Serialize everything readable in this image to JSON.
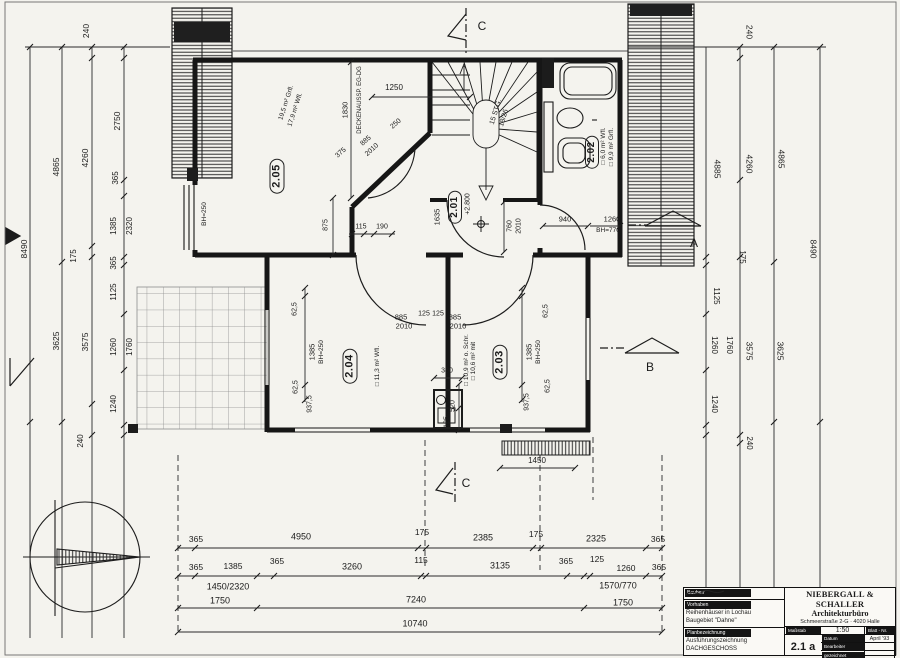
{
  "drawing_title": "DACHGESCHOSS",
  "title_block": {
    "owner_label": "Bauherr",
    "project_label": "Vorhaben",
    "project_line1": "Reihenhäuser in Lochau",
    "project_line2": "Baugebiet \"Dahne\"",
    "plan_label": "Planbezeichnung",
    "plan_line1": "Ausführungszeichnung",
    "plan_line2": "DACHGESCHOSS",
    "firm_name": "NIEBERGALL & SCHALLER",
    "firm_type": "Architekturbüro",
    "firm_address": "Schmeerstraße 2-G · 4020 Halle",
    "scale_label": "Maßstab",
    "scale_value": "1:50",
    "sheet_label": "Blatt - Nr.",
    "sheet_value": "2.1 a",
    "date_label": "Datum",
    "date_value": "April '93",
    "editor_label": "Bearbeiter",
    "drawn_label": "gezeichnet"
  },
  "plan_labels": [
    {
      "t": "2.05",
      "x": 277,
      "y": 176,
      "r": -90,
      "s": 11,
      "c": "room"
    },
    {
      "t": "2.01",
      "x": 455,
      "y": 207,
      "r": -90,
      "s": 10,
      "c": "room"
    },
    {
      "t": "2.02",
      "x": 592,
      "y": 152,
      "r": -90,
      "s": 10,
      "c": "room"
    },
    {
      "t": "2.04",
      "x": 350,
      "y": 366,
      "r": -90,
      "s": 11,
      "c": "room"
    },
    {
      "t": "2.03",
      "x": 500,
      "y": 362,
      "r": -90,
      "s": 11,
      "c": "room"
    },
    {
      "t": "19,5 m² Grfl.",
      "x": 287,
      "y": 103,
      "r": -72,
      "s": 6.5,
      "c": "note"
    },
    {
      "t": "17,9 m² Wfl.",
      "x": 296,
      "y": 110,
      "r": -72,
      "s": 6.5,
      "c": "note"
    },
    {
      "t": "□ 6,0 m² Wfl.",
      "x": 604,
      "y": 146,
      "r": -90,
      "s": 6.5,
      "c": "note"
    },
    {
      "t": "□ 9,9 m² Grfl.",
      "x": 612,
      "y": 147,
      "r": -90,
      "s": 6.5,
      "c": "note"
    },
    {
      "t": "□ 11,3 m² Wfl.",
      "x": 378,
      "y": 366,
      "r": -90,
      "s": 6.5,
      "c": "note"
    },
    {
      "t": "□ 10,9 m² o. Schr.",
      "x": 467,
      "y": 360,
      "r": -90,
      "s": 6.5,
      "c": "note"
    },
    {
      "t": "□ 10,6 m² mit",
      "x": 474,
      "y": 361,
      "r": -90,
      "s": 6.5,
      "c": "note"
    },
    {
      "t": "15 STG.",
      "x": 496,
      "y": 112,
      "r": -73,
      "s": 7,
      "c": "note"
    },
    {
      "t": "18/26",
      "x": 504,
      "y": 118,
      "r": -73,
      "s": 7,
      "c": "note"
    },
    {
      "t": "DECKENAUSSP. EG-DG",
      "x": 360,
      "y": 100,
      "r": -90,
      "s": 6,
      "c": "note"
    },
    {
      "t": "1830",
      "x": 345,
      "y": 110,
      "r": -90,
      "s": 7.5
    },
    {
      "t": "1250",
      "x": 394,
      "y": 88,
      "s": 8
    },
    {
      "t": "375",
      "x": 341,
      "y": 153,
      "r": -42,
      "s": 7
    },
    {
      "t": "885",
      "x": 366,
      "y": 141,
      "r": -42,
      "s": 7
    },
    {
      "t": "2010",
      "x": 372,
      "y": 150,
      "r": -42,
      "s": 7
    },
    {
      "t": "250",
      "x": 396,
      "y": 124,
      "r": -42,
      "s": 7
    },
    {
      "t": "BH=250",
      "x": 205,
      "y": 214,
      "r": -90,
      "s": 6.5
    },
    {
      "t": "875",
      "x": 326,
      "y": 225,
      "r": -90,
      "s": 7
    },
    {
      "t": "115",
      "x": 361,
      "y": 227,
      "s": 7
    },
    {
      "t": "190",
      "x": 382,
      "y": 227,
      "s": 7
    },
    {
      "t": "1635",
      "x": 437,
      "y": 217,
      "r": -90,
      "s": 7.5
    },
    {
      "t": "+2.800",
      "x": 468,
      "y": 204,
      "r": -90,
      "s": 7
    },
    {
      "t": "760",
      "x": 510,
      "y": 226,
      "r": -90,
      "s": 7
    },
    {
      "t": "2010",
      "x": 519,
      "y": 226,
      "r": -90,
      "s": 7
    },
    {
      "t": "940",
      "x": 565,
      "y": 219,
      "s": 7.5
    },
    {
      "t": "1260",
      "x": 612,
      "y": 219,
      "s": 7.5
    },
    {
      "t": "BH=770",
      "x": 608,
      "y": 231,
      "s": 6.5
    },
    {
      "t": "62,5",
      "x": 295,
      "y": 309,
      "r": -90,
      "s": 7
    },
    {
      "t": "62,5",
      "x": 296,
      "y": 387,
      "r": -90,
      "s": 7
    },
    {
      "t": "1385",
      "x": 312,
      "y": 352,
      "r": -90,
      "s": 7.5
    },
    {
      "t": "BH=250",
      "x": 322,
      "y": 352,
      "r": -90,
      "s": 6.5
    },
    {
      "t": "937,5",
      "x": 310,
      "y": 404,
      "r": -90,
      "s": 7
    },
    {
      "t": "885",
      "x": 401,
      "y": 317,
      "s": 7.5
    },
    {
      "t": "2010",
      "x": 404,
      "y": 326,
      "s": 7.5
    },
    {
      "t": "125",
      "x": 424,
      "y": 314,
      "s": 7
    },
    {
      "t": "125",
      "x": 438,
      "y": 314,
      "s": 7
    },
    {
      "t": "885",
      "x": 455,
      "y": 317,
      "s": 7.5
    },
    {
      "t": "2010",
      "x": 458,
      "y": 326,
      "s": 7.5
    },
    {
      "t": "62,5",
      "x": 546,
      "y": 311,
      "r": -90,
      "s": 7
    },
    {
      "t": "62,5",
      "x": 548,
      "y": 386,
      "r": -90,
      "s": 7
    },
    {
      "t": "1385",
      "x": 529,
      "y": 352,
      "r": -90,
      "s": 7.5
    },
    {
      "t": "BH=250",
      "x": 539,
      "y": 352,
      "r": -90,
      "s": 6.5
    },
    {
      "t": "937,5",
      "x": 527,
      "y": 402,
      "r": -90,
      "s": 7
    },
    {
      "t": "380",
      "x": 447,
      "y": 371,
      "s": 7
    },
    {
      "t": "520",
      "x": 453,
      "y": 406,
      "r": -90,
      "s": 7
    },
    {
      "t": "125",
      "x": 447,
      "y": 422,
      "r": -90,
      "s": 7
    },
    {
      "t": "1450",
      "x": 537,
      "y": 461,
      "s": 8
    },
    {
      "t": "240",
      "x": 86,
      "y": 31,
      "r": -90,
      "s": 8.5
    },
    {
      "t": "2750",
      "x": 117,
      "y": 121,
      "r": -90,
      "s": 8.5
    },
    {
      "t": "4865",
      "x": 56,
      "y": 167,
      "r": -90,
      "s": 8.5
    },
    {
      "t": "4260",
      "x": 85,
      "y": 158,
      "r": -90,
      "s": 8.5
    },
    {
      "t": "365",
      "x": 116,
      "y": 178,
      "r": -90,
      "s": 8
    },
    {
      "t": "1385",
      "x": 114,
      "y": 226,
      "r": -90,
      "s": 8
    },
    {
      "t": "2320",
      "x": 130,
      "y": 226,
      "r": -90,
      "s": 8
    },
    {
      "t": "8490",
      "x": 24,
      "y": 249,
      "r": -90,
      "s": 8.5
    },
    {
      "t": "175",
      "x": 74,
      "y": 256,
      "r": -90,
      "s": 8
    },
    {
      "t": "365",
      "x": 114,
      "y": 263,
      "r": -90,
      "s": 8
    },
    {
      "t": "1125",
      "x": 114,
      "y": 292,
      "r": -90,
      "s": 8
    },
    {
      "t": "3625",
      "x": 56,
      "y": 341,
      "r": -90,
      "s": 8.5
    },
    {
      "t": "3575",
      "x": 85,
      "y": 342,
      "r": -90,
      "s": 8.5
    },
    {
      "t": "1260",
      "x": 114,
      "y": 347,
      "r": -90,
      "s": 8
    },
    {
      "t": "1760",
      "x": 130,
      "y": 347,
      "r": -90,
      "s": 8
    },
    {
      "t": "1240",
      "x": 114,
      "y": 404,
      "r": -90,
      "s": 8
    },
    {
      "t": "240",
      "x": 81,
      "y": 441,
      "r": -90,
      "s": 8
    },
    {
      "t": "240",
      "x": 749,
      "y": 32,
      "r": 90,
      "s": 8.5
    },
    {
      "t": "4885",
      "x": 717,
      "y": 169,
      "r": 90,
      "s": 8.5
    },
    {
      "t": "4260",
      "x": 749,
      "y": 164,
      "r": 90,
      "s": 8.5
    },
    {
      "t": "4865",
      "x": 781,
      "y": 159,
      "r": 90,
      "s": 8.5
    },
    {
      "t": "8490",
      "x": 813,
      "y": 249,
      "r": 90,
      "s": 8.5
    },
    {
      "t": "175",
      "x": 742,
      "y": 257,
      "r": 90,
      "s": 8
    },
    {
      "t": "1125",
      "x": 716,
      "y": 296,
      "r": 90,
      "s": 8
    },
    {
      "t": "1260",
      "x": 714,
      "y": 345,
      "r": 90,
      "s": 8
    },
    {
      "t": "1760",
      "x": 729,
      "y": 345,
      "r": 90,
      "s": 8
    },
    {
      "t": "3575",
      "x": 749,
      "y": 351,
      "r": 90,
      "s": 8.5
    },
    {
      "t": "3625",
      "x": 780,
      "y": 351,
      "r": 90,
      "s": 8.5
    },
    {
      "t": "1240",
      "x": 714,
      "y": 404,
      "r": 90,
      "s": 8
    },
    {
      "t": "240",
      "x": 749,
      "y": 443,
      "r": 90,
      "s": 8
    },
    {
      "t": "365",
      "x": 196,
      "y": 539,
      "s": 8.5
    },
    {
      "t": "4950",
      "x": 301,
      "y": 537,
      "s": 9
    },
    {
      "t": "175",
      "x": 422,
      "y": 532,
      "s": 8.5
    },
    {
      "t": "2385",
      "x": 483,
      "y": 538,
      "s": 9
    },
    {
      "t": "175",
      "x": 536,
      "y": 534,
      "s": 8.5
    },
    {
      "t": "2325",
      "x": 596,
      "y": 539,
      "s": 9
    },
    {
      "t": "365",
      "x": 658,
      "y": 539,
      "s": 8.5
    },
    {
      "t": "365",
      "x": 196,
      "y": 567,
      "s": 8.5
    },
    {
      "t": "1385",
      "x": 233,
      "y": 566,
      "s": 8.5
    },
    {
      "t": "365",
      "x": 277,
      "y": 561,
      "s": 8.5
    },
    {
      "t": "3260",
      "x": 352,
      "y": 567,
      "s": 9
    },
    {
      "t": "115",
      "x": 421,
      "y": 560,
      "s": 8.5
    },
    {
      "t": "3135",
      "x": 500,
      "y": 566,
      "s": 9
    },
    {
      "t": "365",
      "x": 566,
      "y": 561,
      "s": 8.5
    },
    {
      "t": "125",
      "x": 597,
      "y": 559,
      "s": 8.5
    },
    {
      "t": "1260",
      "x": 626,
      "y": 568,
      "s": 8.5
    },
    {
      "t": "365",
      "x": 659,
      "y": 567,
      "s": 8.5
    },
    {
      "t": "1450/2320",
      "x": 228,
      "y": 587,
      "s": 9
    },
    {
      "t": "1750",
      "x": 220,
      "y": 601,
      "s": 9
    },
    {
      "t": "7240",
      "x": 416,
      "y": 600,
      "s": 9
    },
    {
      "t": "1570/770",
      "x": 618,
      "y": 586,
      "s": 9
    },
    {
      "t": "1750",
      "x": 623,
      "y": 603,
      "s": 9
    },
    {
      "t": "10740",
      "x": 415,
      "y": 624,
      "s": 9
    },
    {
      "t": "A",
      "x": 694,
      "y": 243,
      "s": 12,
      "c": "marker"
    },
    {
      "t": "B",
      "x": 650,
      "y": 367,
      "s": 12,
      "c": "marker"
    },
    {
      "t": "C",
      "x": 482,
      "y": 26,
      "s": 12,
      "c": "marker"
    },
    {
      "t": "C",
      "x": 466,
      "y": 483,
      "s": 12,
      "c": "marker"
    }
  ]
}
